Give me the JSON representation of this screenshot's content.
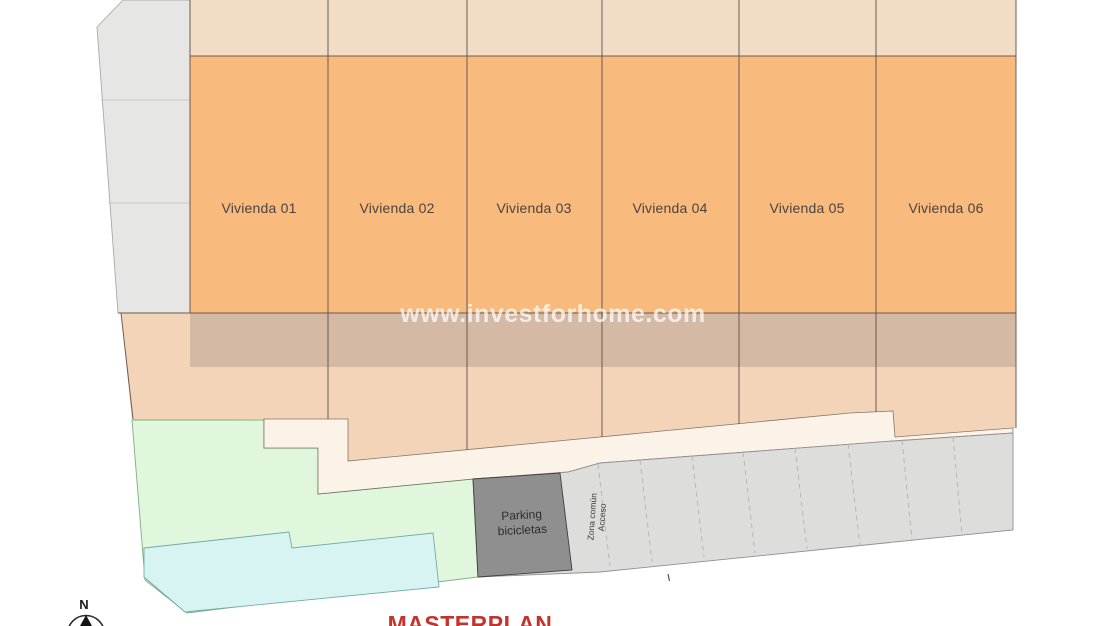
{
  "title": "MASTERPLAN",
  "watermark": "www.investforhome.com",
  "compass": {
    "north_label": "N"
  },
  "plots": [
    {
      "label": "Vivienda 01"
    },
    {
      "label": "Vivienda 02"
    },
    {
      "label": "Vivienda 03"
    },
    {
      "label": "Vivienda 04"
    },
    {
      "label": "Vivienda 05"
    },
    {
      "label": "Vivienda 06"
    }
  ],
  "bike_parking": {
    "line1": "Parking",
    "line2": "bicicletas"
  },
  "access_corridor": {
    "label": "Acceso Zona común",
    "line_left": "Zona común",
    "line_right": "Acceso"
  },
  "colors": {
    "plot_orange": "#F9BA7E",
    "strip_peach": "#F2DCC6",
    "lower_peach": "#F3D4B8",
    "walkway_cream": "#FBF2E8",
    "green_zone": "#E0F7DD",
    "pool_cyan": "#D7F4F2",
    "road_gray": "#E6E6E5",
    "lot_gray": "#DDDDDC",
    "bike_gray": "#8F8F8F",
    "line_dark": "#5B5048",
    "title_red": "#C4342E",
    "label_dark": "#4B4340"
  }
}
